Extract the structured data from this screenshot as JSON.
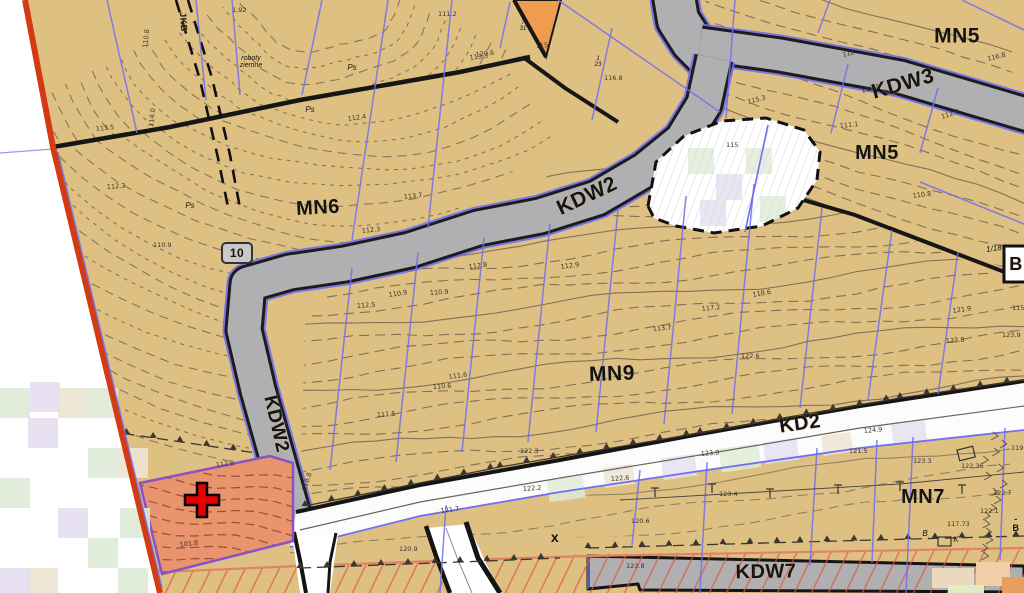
{
  "map": {
    "title": "Miejscowy plan zagospodarowania przestrzennego - raster",
    "colors": {
      "tan": "#dec083",
      "contour": "#6b5d4d",
      "road_gray": "#b0afb1",
      "road_edge": "#1c1c1c",
      "parcel_blue": "#6f6ff0",
      "boundary_red": "#d43b12",
      "selection_salmon": "#e8946c",
      "selection_contour": "#8f4230",
      "selection_border_purple": "#8952c8",
      "cross_red": "#e80000",
      "orange_parcel": "#f09c4e",
      "hatch_red": "#dd5b43",
      "hatch_border_salmon": "#e08366",
      "kd2_white": "#fcfcfc",
      "blob_white": "#ffffff",
      "pastel_green": "#deebd6",
      "pastel_lavender": "#e4def0",
      "pastel_beige": "#ece4d2"
    },
    "labels": [
      {
        "name": "zone-label-mn5-top",
        "text": "MN5",
        "x": 957,
        "y": 36,
        "rot": 0,
        "size": 21
      },
      {
        "name": "road-label-kdw3",
        "text": "KDW3",
        "x": 903,
        "y": 84,
        "rot": -16,
        "size": 21
      },
      {
        "name": "zone-label-mn5-mid",
        "text": "MN5",
        "x": 877,
        "y": 153,
        "rot": 0,
        "size": 20
      },
      {
        "name": "zone-label-mn6",
        "text": "MN6",
        "x": 318,
        "y": 208,
        "rot": -3,
        "size": 20
      },
      {
        "name": "road-label-kdw2-diag",
        "text": "KDW2",
        "x": 587,
        "y": 196,
        "rot": -25,
        "size": 21
      },
      {
        "name": "zone-label-mn9",
        "text": "MN9",
        "x": 612,
        "y": 374,
        "rot": -2,
        "size": 21
      },
      {
        "name": "road-label-kd2",
        "text": "KD2",
        "x": 800,
        "y": 424,
        "rot": -8,
        "size": 20
      },
      {
        "name": "road-label-kdw2-vert",
        "text": "KDW2",
        "x": 276,
        "y": 424,
        "rot": 77,
        "size": 19
      },
      {
        "name": "zone-label-mn7",
        "text": "MN7",
        "x": 923,
        "y": 497,
        "rot": 0,
        "size": 20
      },
      {
        "name": "road-label-kdw7",
        "text": "KDW7",
        "x": 766,
        "y": 572,
        "rot": -1,
        "size": 20
      },
      {
        "name": "route-number-marker",
        "text": "10",
        "x": 237,
        "y": 253,
        "rot": 0,
        "size": 12
      },
      {
        "name": "utility-line-label",
        "text": "JKB",
        "x": 183,
        "y": 22,
        "rot": 86,
        "size": 9
      },
      {
        "name": "x-mark",
        "text": "x",
        "x": 555,
        "y": 537,
        "rot": 0,
        "size": 14
      },
      {
        "name": "parcel-ref-1-18",
        "text": "1/18",
        "x": 994,
        "y": 249,
        "rot": -8,
        "size": 8,
        "light": true
      },
      {
        "name": "parcel-ref-7-31",
        "text": "7\n31",
        "x": 523,
        "y": 26,
        "rot": 0,
        "size": 6,
        "light": true
      },
      {
        "name": "parcel-ref-1-23",
        "text": "1\n23",
        "x": 598,
        "y": 62,
        "rot": 0,
        "size": 6,
        "light": true
      },
      {
        "name": "note-earthworks",
        "text": "roboty\nziemne",
        "x": 251,
        "y": 62,
        "rot": 0,
        "size": 7,
        "light": true
      },
      {
        "name": "boundary-letter-b",
        "text": "B",
        "x": 1016,
        "y": 264,
        "rot": 0,
        "size": 18
      },
      {
        "name": "soil-label-ps-1",
        "text": "Ps",
        "x": 190,
        "y": 206,
        "rot": 0,
        "size": 8,
        "light": true
      },
      {
        "name": "soil-label-ps-2",
        "text": "Ps",
        "x": 352,
        "y": 68,
        "rot": 0,
        "size": 8,
        "light": true
      },
      {
        "name": "soil-label-ps-3",
        "text": "Ps",
        "x": 310,
        "y": 110,
        "rot": 0,
        "size": 8,
        "light": true
      },
      {
        "name": "letter-b-small",
        "text": "B",
        "x": 925,
        "y": 534,
        "rot": 0,
        "size": 8,
        "light": true
      },
      {
        "name": "letter-k-small",
        "text": "K",
        "x": 956,
        "y": 540,
        "rot": 0,
        "size": 8,
        "light": true
      },
      {
        "name": "letter-b-dash",
        "text": "-B",
        "x": 1016,
        "y": 524,
        "rot": 0,
        "size": 9
      }
    ],
    "spot_heights": [
      {
        "t": "110.8",
        "x": 147,
        "y": 48,
        "r": -83
      },
      {
        "t": "114.0",
        "x": 153,
        "y": 127,
        "r": -83
      },
      {
        "t": "113.5",
        "x": 96,
        "y": 131,
        "r": -6
      },
      {
        "t": "112.3",
        "x": 107,
        "y": 189,
        "r": -4
      },
      {
        "t": "110.9",
        "x": 153,
        "y": 247,
        "r": 0
      },
      {
        "t": "101.8",
        "x": 180,
        "y": 547,
        "r": -8
      },
      {
        "t": "111.8",
        "x": 216,
        "y": 467,
        "r": -6
      },
      {
        "t": "118.8",
        "x": 306,
        "y": 491,
        "r": -72
      },
      {
        "t": "111.2",
        "x": 438,
        "y": 16,
        "r": 0
      },
      {
        "t": "113.3",
        "x": 470,
        "y": 60,
        "r": -8
      },
      {
        "t": "112.4",
        "x": 348,
        "y": 121,
        "r": -8
      },
      {
        "t": "113.7",
        "x": 404,
        "y": 199,
        "r": -6
      },
      {
        "t": "112.3",
        "x": 362,
        "y": 233,
        "r": -6
      },
      {
        "t": "115",
        "x": 536,
        "y": 48,
        "r": -5
      },
      {
        "t": "116.8",
        "x": 604,
        "y": 80,
        "r": 0
      },
      {
        "t": "115",
        "x": 726,
        "y": 147,
        "r": 0
      },
      {
        "t": "118",
        "x": 843,
        "y": 57,
        "r": -14
      },
      {
        "t": "112.4",
        "x": 862,
        "y": 93,
        "r": -16
      },
      {
        "t": "116.8",
        "x": 988,
        "y": 61,
        "r": -14
      },
      {
        "t": "112.9",
        "x": 942,
        "y": 119,
        "r": -18
      },
      {
        "t": "111.1",
        "x": 840,
        "y": 128,
        "r": -6
      },
      {
        "t": "115.3",
        "x": 748,
        "y": 104,
        "r": -14
      },
      {
        "t": "110.8",
        "x": 913,
        "y": 198,
        "r": -8
      },
      {
        "t": "121.9",
        "x": 953,
        "y": 313,
        "r": -8
      },
      {
        "t": "123.9",
        "x": 1002,
        "y": 337,
        "r": 0
      },
      {
        "t": "118.6",
        "x": 753,
        "y": 297,
        "r": -10
      },
      {
        "t": "117.2",
        "x": 702,
        "y": 311,
        "r": -6
      },
      {
        "t": "112.9",
        "x": 561,
        "y": 269,
        "r": -8
      },
      {
        "t": "112.8",
        "x": 469,
        "y": 269,
        "r": -8
      },
      {
        "t": "110.9",
        "x": 389,
        "y": 297,
        "r": -8
      },
      {
        "t": "112.5",
        "x": 357,
        "y": 308,
        "r": -4
      },
      {
        "t": "110.6",
        "x": 433,
        "y": 389,
        "r": -4
      },
      {
        "t": "111.5",
        "x": 377,
        "y": 417,
        "r": -4
      },
      {
        "t": "111.6",
        "x": 449,
        "y": 379,
        "r": -8
      },
      {
        "t": "113.7",
        "x": 653,
        "y": 331,
        "r": -5
      },
      {
        "t": "122.6",
        "x": 741,
        "y": 358,
        "r": 0
      },
      {
        "t": "123.8",
        "x": 946,
        "y": 343,
        "r": -4
      },
      {
        "t": "121.7",
        "x": 441,
        "y": 513,
        "r": -8
      },
      {
        "t": "122.2",
        "x": 523,
        "y": 491,
        "r": -4
      },
      {
        "t": "122.6",
        "x": 611,
        "y": 481,
        "r": -4
      },
      {
        "t": "123.8",
        "x": 701,
        "y": 456,
        "r": -5
      },
      {
        "t": "124.9",
        "x": 864,
        "y": 433,
        "r": -5
      },
      {
        "t": "121.5",
        "x": 849,
        "y": 453,
        "r": 0
      },
      {
        "t": "120.6",
        "x": 631,
        "y": 523,
        "r": 0
      },
      {
        "t": "123.8",
        "x": 626,
        "y": 568,
        "r": 0
      },
      {
        "t": "122.36",
        "x": 961,
        "y": 468,
        "r": 0
      },
      {
        "t": "117.73",
        "x": 947,
        "y": 526,
        "r": 0
      },
      {
        "t": "122.7",
        "x": 993,
        "y": 495,
        "r": 0
      },
      {
        "t": "122.1",
        "x": 980,
        "y": 513,
        "r": 0
      },
      {
        "t": "123.3",
        "x": 913,
        "y": 463,
        "r": 0
      },
      {
        "t": "119.9",
        "x": 1011,
        "y": 450,
        "r": 0
      },
      {
        "t": "122.3",
        "x": 520,
        "y": 453,
        "r": 0
      },
      {
        "t": "123.4",
        "x": 719,
        "y": 496,
        "r": 0
      },
      {
        "t": "120.9",
        "x": 399,
        "y": 551,
        "r": 0
      },
      {
        "t": "120.6",
        "x": 476,
        "y": 57,
        "r": -8
      },
      {
        "t": "110.9",
        "x": 430,
        "y": 295,
        "r": -4
      },
      {
        "t": "1,92",
        "x": 232,
        "y": 12,
        "r": 0
      },
      {
        "t": "115.6",
        "x": 1012,
        "y": 310,
        "r": 0
      }
    ],
    "selection_cross": {
      "x": 202,
      "y": 500
    }
  }
}
